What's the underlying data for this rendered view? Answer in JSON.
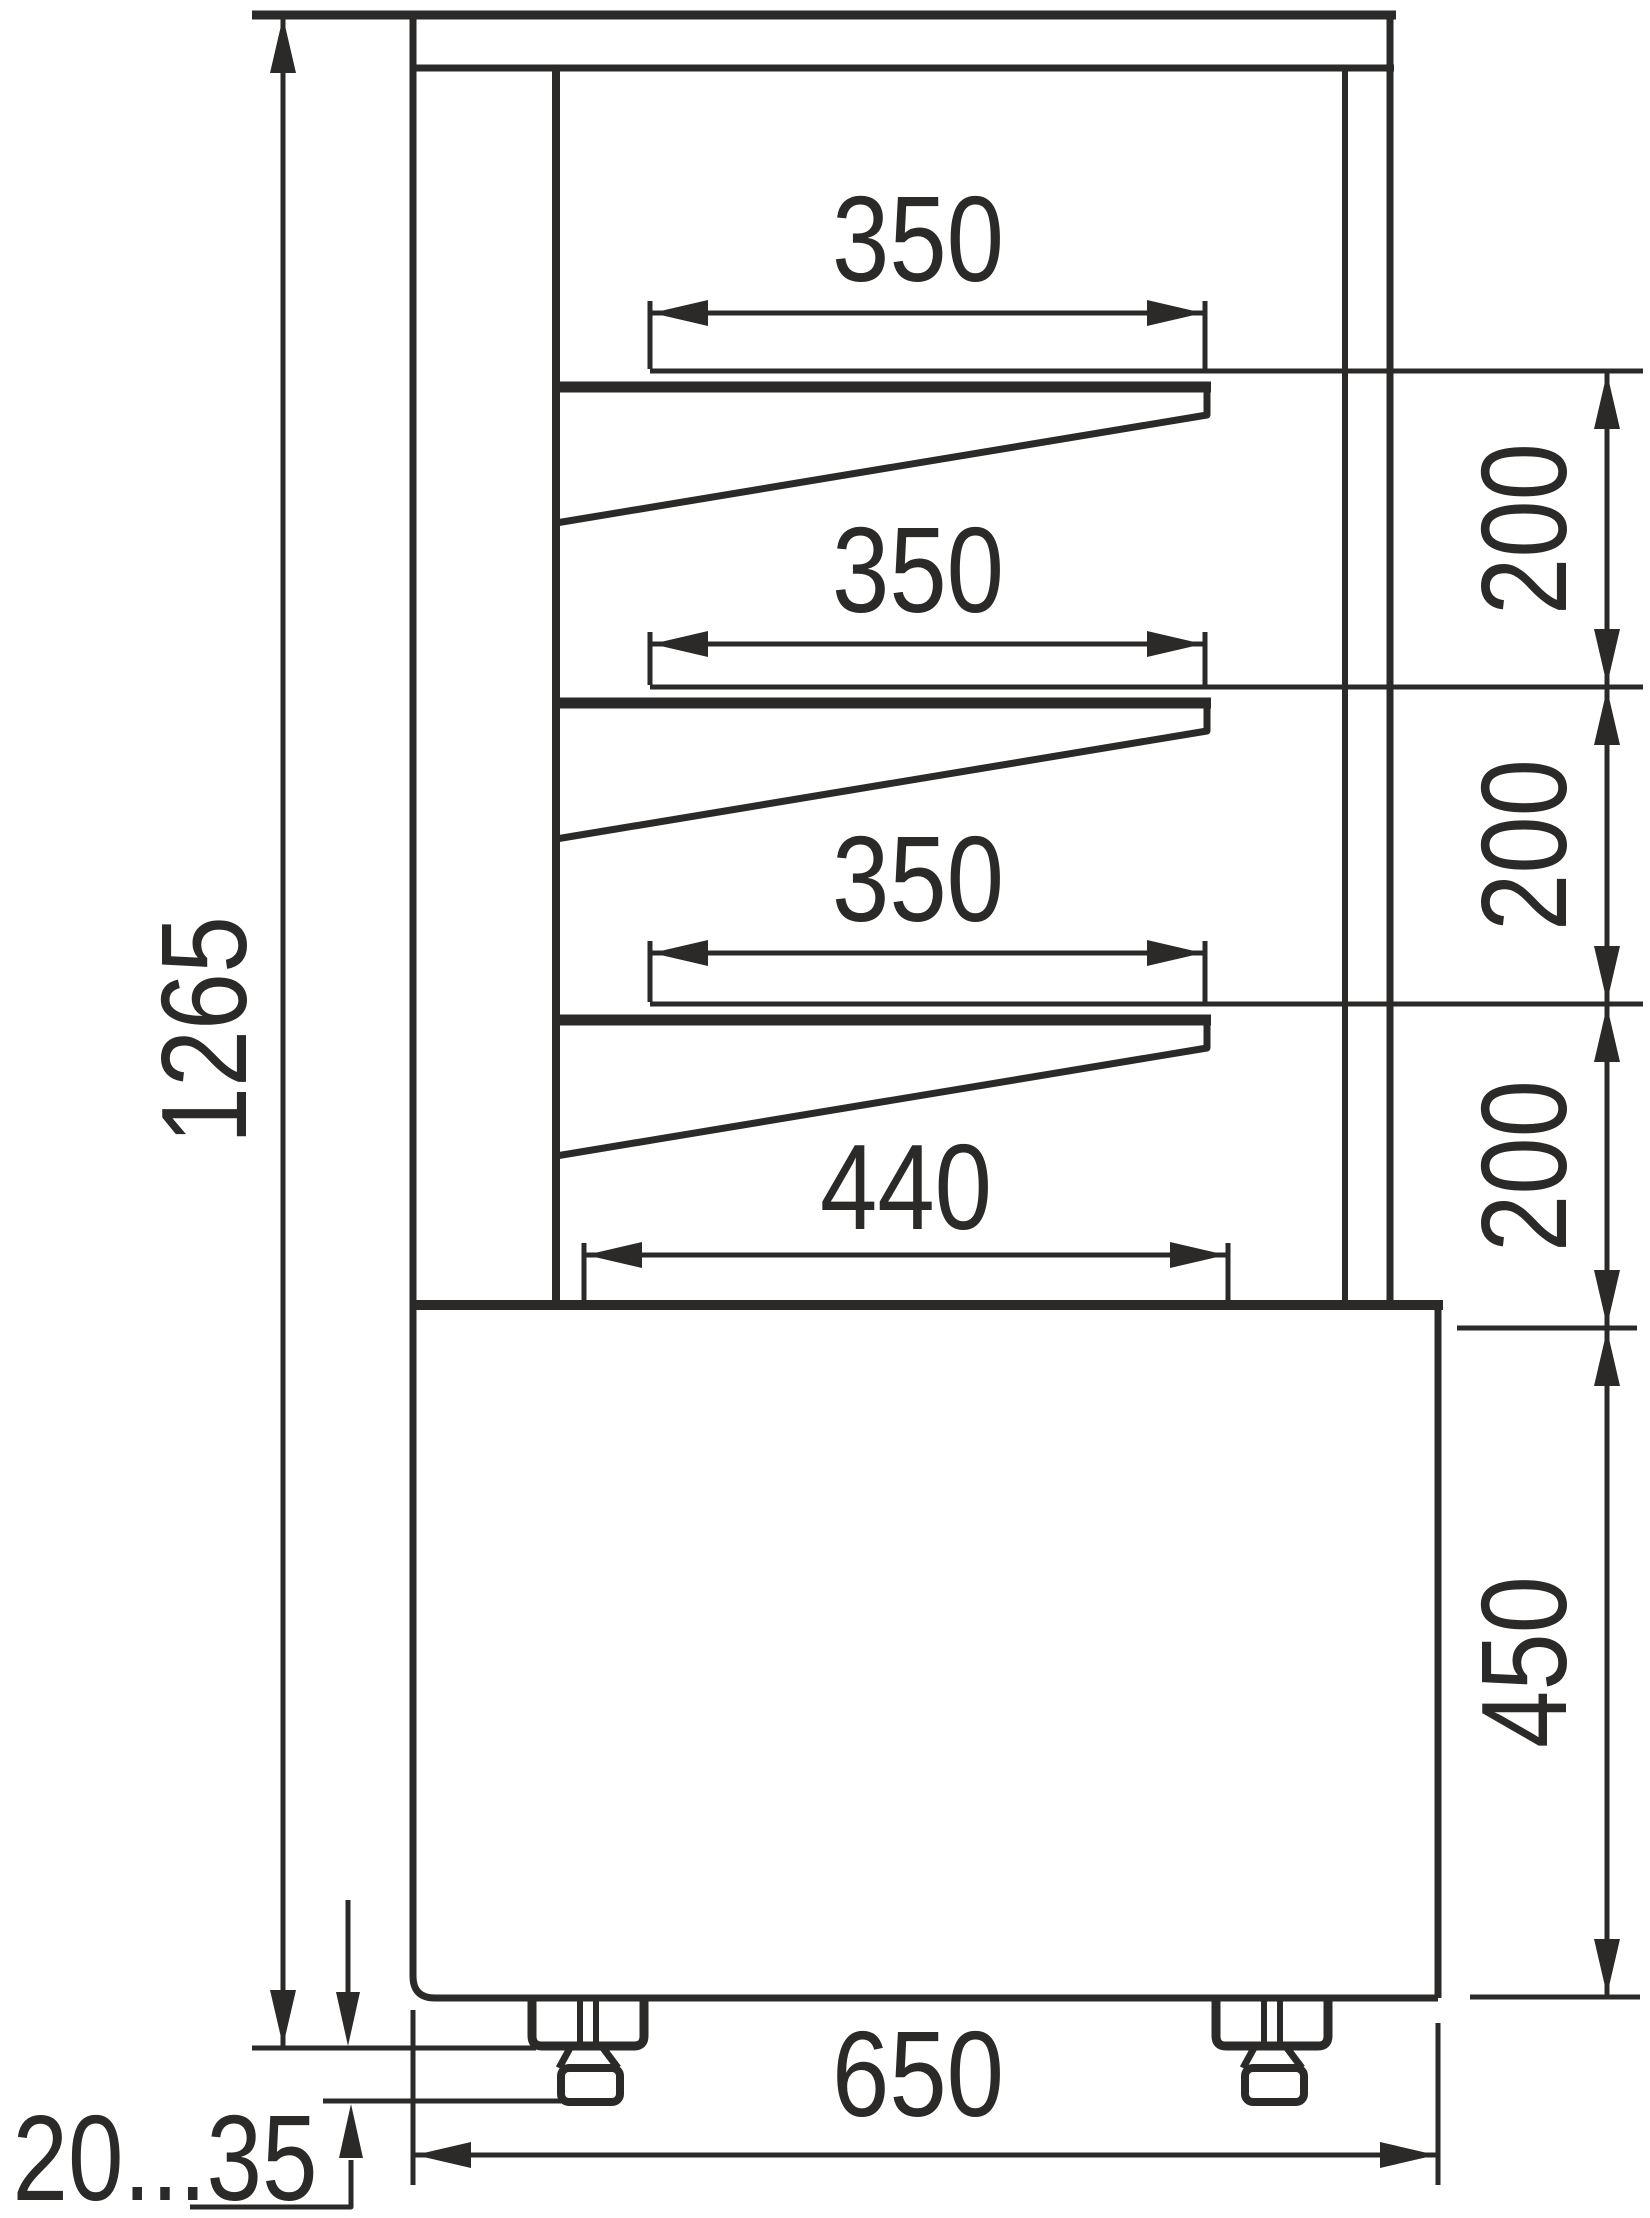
{
  "drawing": {
    "background_color": "#ffffff",
    "line_color": "#2b2a29",
    "labels": {
      "overall_height": "1265",
      "shelf1_depth": "350",
      "shelf2_depth": "350",
      "shelf3_depth": "350",
      "bottom_deck_depth": "440",
      "gap1": "200",
      "gap2": "200",
      "gap3": "200",
      "base_height": "450",
      "overall_depth": "650",
      "foot_height_range": "20...35"
    }
  }
}
